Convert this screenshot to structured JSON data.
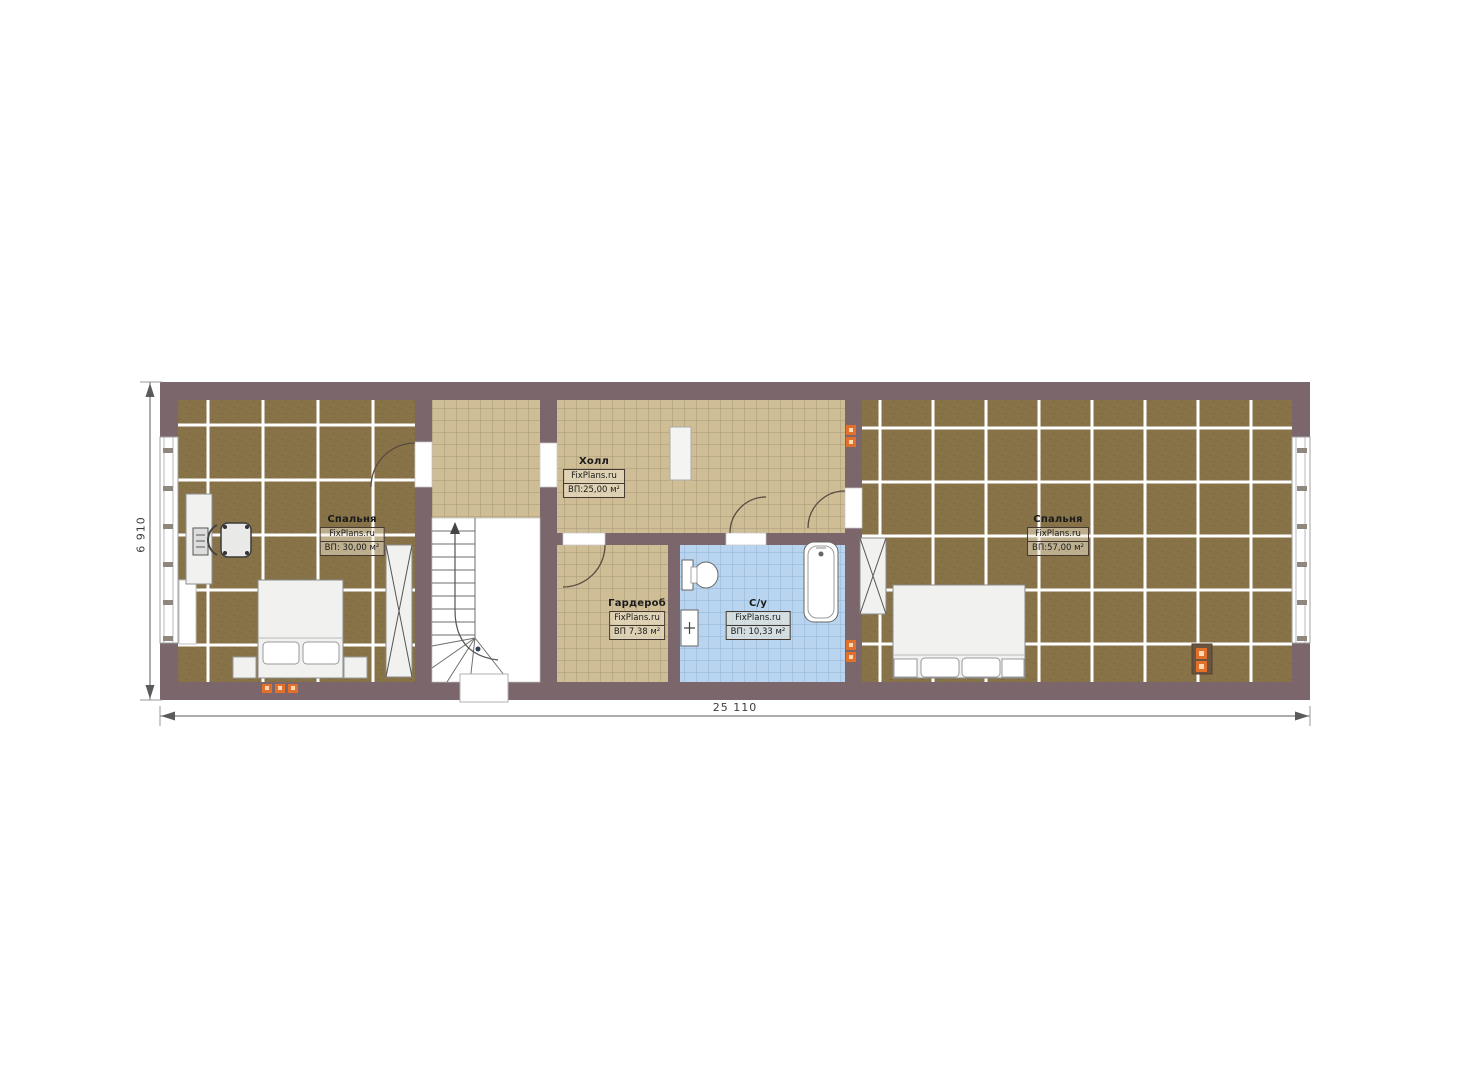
{
  "palette": {
    "wall": "#7b666c",
    "wood": "#887349",
    "wood_dark": "#74603c",
    "tile_beige": "#cfbd96",
    "tile_grout": "#93876a",
    "tile_blue": "#b9d4ef",
    "tile_blue_grout": "#84a9cf",
    "furniture": "#f1f1ef",
    "socket": "#e2702d",
    "dim": "#5a5a5a"
  },
  "plan": {
    "rooms": [
      {
        "id": "bedroom-left",
        "name": "Спальня",
        "brand": "FixPlans.ru",
        "area": "ВП: 30,00 м²"
      },
      {
        "id": "hall",
        "name": "Холл",
        "brand": "FixPlans.ru",
        "area": "ВП:25,00 м²"
      },
      {
        "id": "wardrobe",
        "name": "Гардероб",
        "brand": "FixPlans.ru",
        "area": "ВП 7,38 м²"
      },
      {
        "id": "bathroom",
        "name": "С/у",
        "brand": "FixPlans.ru",
        "area": "ВП: 10,33 м²"
      },
      {
        "id": "bedroom-right",
        "name": "Спальня",
        "brand": "FixPlans.ru",
        "area": "ВП:57,00 м²"
      }
    ],
    "dimensions": {
      "width_label": "25 110",
      "height_label": "6 910"
    }
  }
}
